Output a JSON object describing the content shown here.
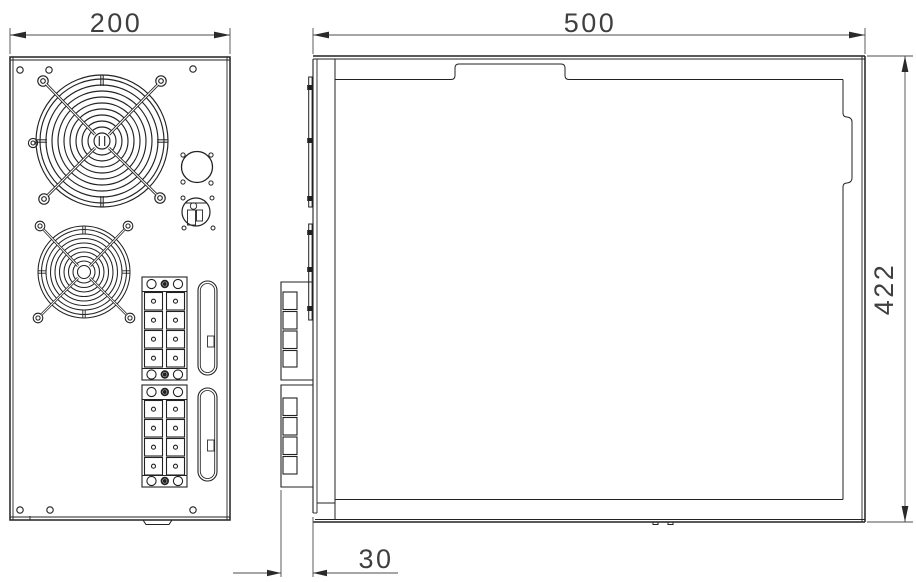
{
  "drawing": {
    "type": "technical-drawing-2-views",
    "colors": {
      "background": "#ffffff",
      "line": "#222222",
      "dimension_line": "#4d4d4d",
      "arrow": "#2a2a2a",
      "text": "#3f3f3f"
    },
    "dimensions": {
      "rear_width": {
        "value": "200"
      },
      "side_depth": {
        "value": "500"
      },
      "side_height": {
        "value": "422"
      },
      "rear_protrusion": {
        "value": "30"
      }
    },
    "views": {
      "rear_view": {
        "components": [
          "large-fan-grille",
          "small-fan-grille",
          "ground-terminal",
          "power-inlet-hole",
          "fuse-holder",
          "terminal-block-upper",
          "terminal-block-lower",
          "slot-upper",
          "slot-lower",
          "mounting-holes",
          "bottom-tab"
        ]
      },
      "side_view": {
        "components": [
          "fan-guard-profile-upper",
          "fan-guard-profile-lower",
          "terminal-block-profile-upper",
          "terminal-block-profile-lower",
          "top-recess-tab",
          "right-latch-recess",
          "bottom-feet"
        ]
      }
    }
  }
}
